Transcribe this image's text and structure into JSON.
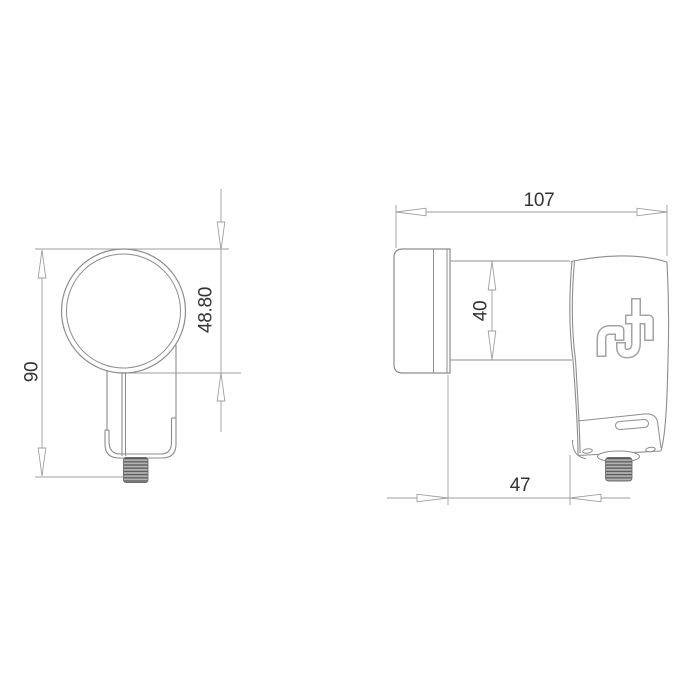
{
  "drawing": {
    "background": "#ffffff",
    "device_line_color": "#8d8d8d",
    "dimension_line_color": "#9e9e9e",
    "text_color": "#333333",
    "logo_icon": "inverto-logo",
    "front_view": {
      "overall_height_label": "90",
      "feedhorn_diameter_label": "48.80"
    },
    "side_view": {
      "overall_length_label": "107",
      "neck_diameter_label": "40",
      "body_length_label": "47"
    }
  }
}
